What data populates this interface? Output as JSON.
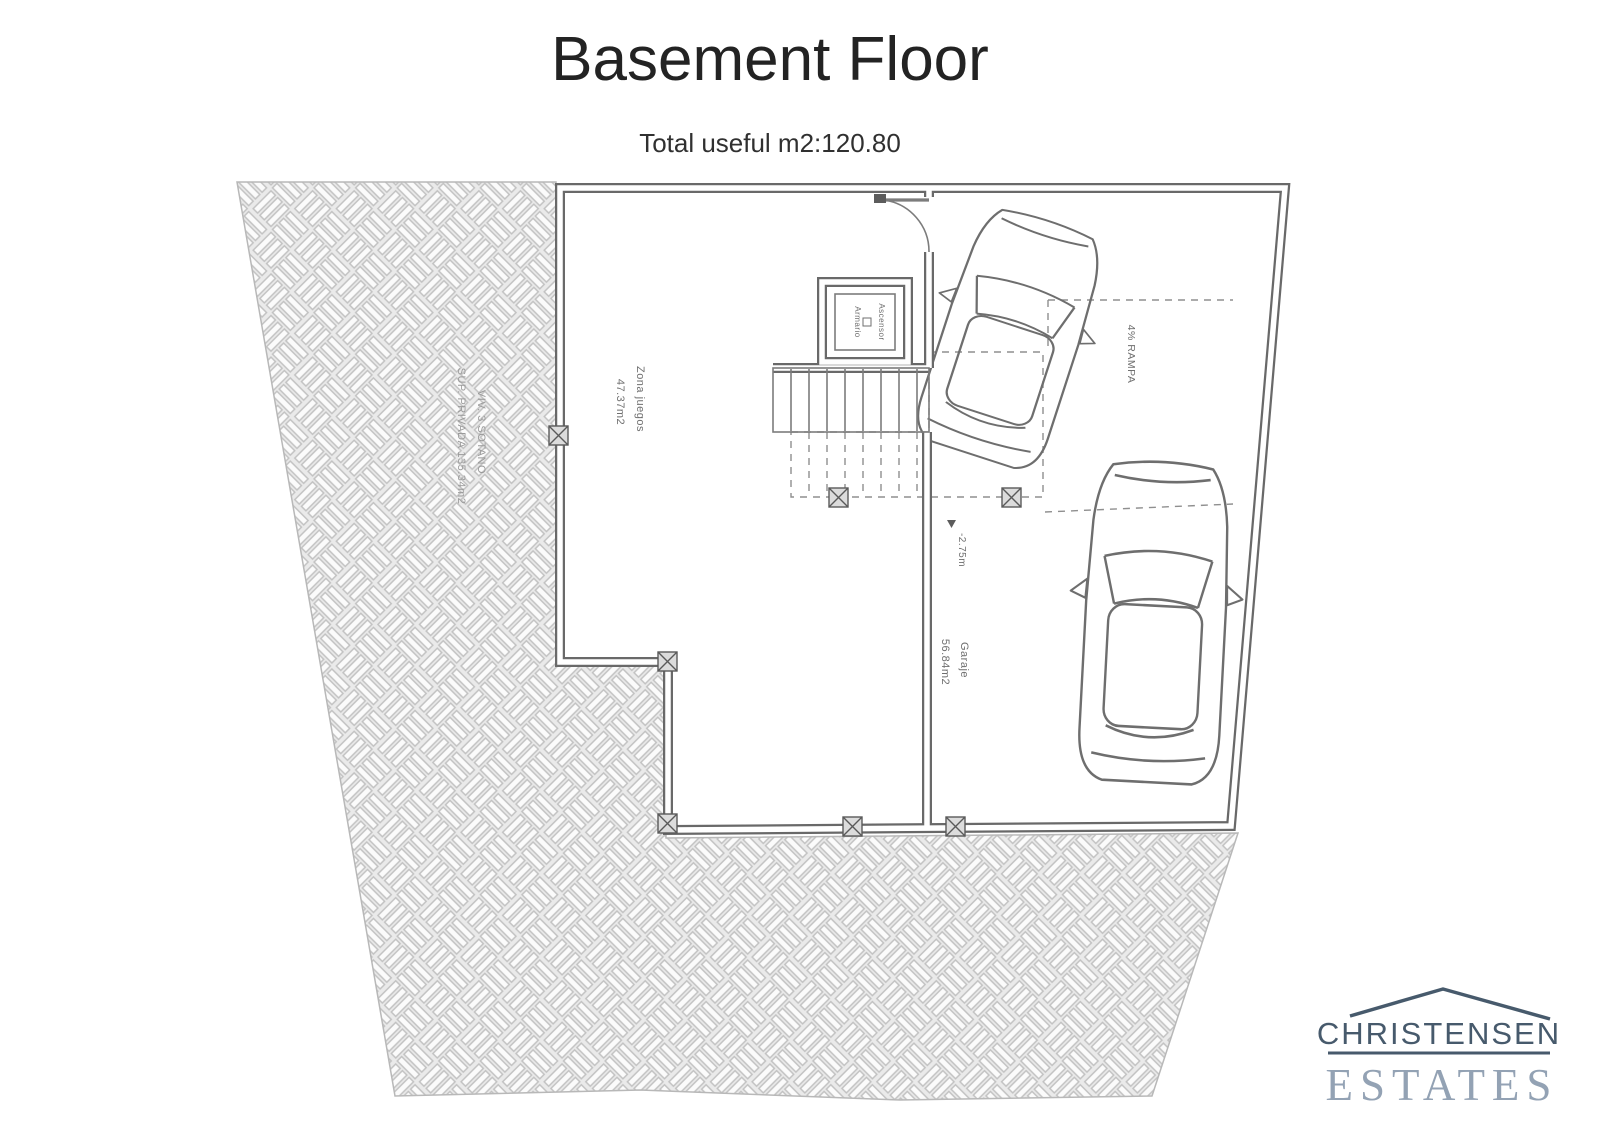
{
  "header": {
    "title": "Basement Floor",
    "subtitle": "Total useful m2:120.80"
  },
  "plan": {
    "colors": {
      "wall": "#696969",
      "line": "#7c7c7c",
      "dash": "#8f8f8f",
      "label": "#6f6f6f",
      "site_label": "#9a9a9a"
    },
    "labels": {
      "site_line1": "SUP. PRIVADA 135.34m2",
      "site_line2": "VIV. 3 SOTANO",
      "play_line1": "47.37m2",
      "play_line2": "Zona juegos",
      "lift_line1": "Armario",
      "lift_line2": "Ascensor",
      "ramp": "4% RAMPA",
      "level": "-2.75m",
      "garage_line1": "56.84m2",
      "garage_line2": "Garaje"
    }
  },
  "logo": {
    "name": "CHRISTENSEN",
    "type": "ESTATES",
    "color_dark": "#475a6c",
    "color_light": "#93a2b4"
  }
}
